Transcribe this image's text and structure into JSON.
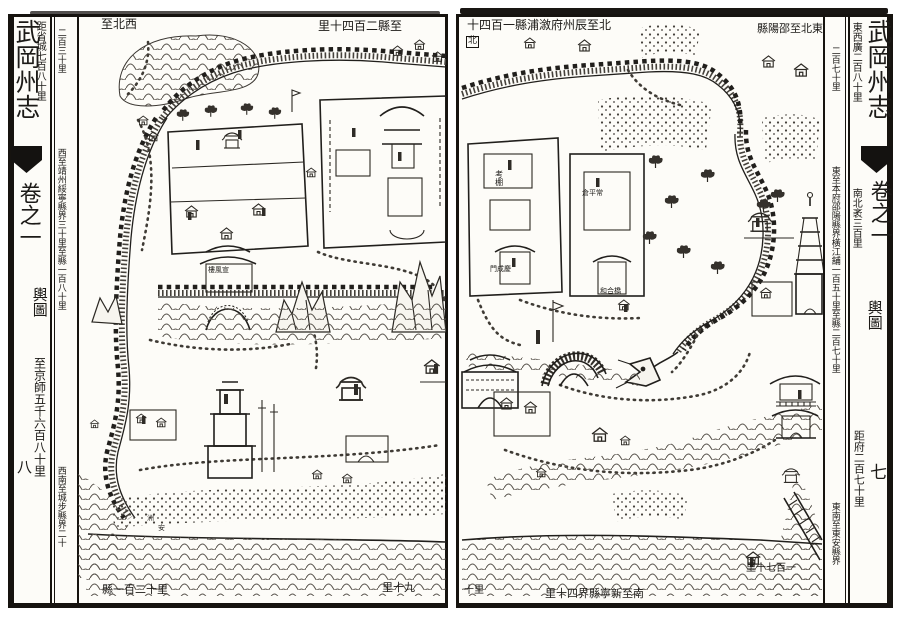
{
  "book": {
    "title": "武岡州志",
    "volume": "卷之一",
    "section": "輿圖"
  },
  "ink_color": "#1c1a17",
  "paper_color": "#fdfcf8",
  "left_page": {
    "page_number": "八",
    "margin_notes": {
      "to_provincial_capital": "距省城七百八十里",
      "to_imperial_capital": "至京師五千六百八十里"
    },
    "texts": [
      {
        "name": "caption-northwest",
        "text": "至北西",
        "x": 101,
        "y": 18,
        "size": 12
      },
      {
        "name": "caption-northwest-distance",
        "text": "里十四百二縣至",
        "x": 318,
        "y": 20,
        "size": 12
      },
      {
        "name": "column-note-north",
        "text": "二百三十里",
        "x": 55,
        "y": 28,
        "vertical": true,
        "size": 9
      },
      {
        "name": "column-note-west",
        "text": "西至靖州綏寧縣界三十里至縣一百八十里",
        "x": 55,
        "y": 148,
        "vertical": true,
        "size": 9
      },
      {
        "name": "column-note-southwest",
        "text": "西南至城步縣界二十",
        "x": 55,
        "y": 466,
        "vertical": true,
        "size": 9
      },
      {
        "name": "caption-south-distance",
        "text": "縣一百二十里",
        "x": 102,
        "y": 584,
        "size": 11
      },
      {
        "name": "caption-south",
        "text": "里十九",
        "x": 382,
        "y": 582,
        "size": 11
      },
      {
        "name": "xuanfeng-tower-label",
        "text": "樓風宣",
        "x": 208,
        "y": 267,
        "size": 7
      },
      {
        "name": "islet-label",
        "text": "洲",
        "x": 146,
        "y": 514,
        "vertical": true,
        "size": 7
      },
      {
        "name": "islet-label-2",
        "text": "安",
        "x": 157,
        "y": 524,
        "vertical": true,
        "size": 7
      }
    ]
  },
  "right_page": {
    "page_number": "七",
    "margin_notes": {
      "east_west_width": "東西廣二百八十里",
      "north_south_length": "南北袤三百里",
      "to_prefecture": "距府二百七十里"
    },
    "texts": [
      {
        "name": "caption-north",
        "text": "十四百一縣浦漵府州辰至北",
        "x": 467,
        "y": 19,
        "size": 12
      },
      {
        "name": "north-marker",
        "text": "北",
        "x": 466,
        "y": 36,
        "size": 9,
        "boxed": true
      },
      {
        "name": "caption-northeast",
        "text": "縣陽邵至北東",
        "x": 757,
        "y": 23,
        "size": 11
      },
      {
        "name": "column-note-northeast",
        "text": "二百七十里",
        "x": 829,
        "y": 46,
        "vertical": true,
        "size": 9
      },
      {
        "name": "column-note-east",
        "text": "東至本府邵陽縣界橫江舖一百五十里至縣二百七十里",
        "x": 829,
        "y": 166,
        "vertical": true,
        "size": 9
      },
      {
        "name": "column-note-southeast",
        "text": "東南至東安縣界",
        "x": 829,
        "y": 502,
        "vertical": true,
        "size": 9
      },
      {
        "name": "caption-south-left",
        "text": "十里",
        "x": 464,
        "y": 586,
        "size": 10
      },
      {
        "name": "caption-south",
        "text": "里十四界縣寧新至南",
        "x": 545,
        "y": 588,
        "size": 11
      },
      {
        "name": "caption-southeast-distance",
        "text": "里十七百一",
        "x": 746,
        "y": 564,
        "size": 10
      },
      {
        "name": "examination-hall-label",
        "text": "考棚",
        "x": 494,
        "y": 170,
        "vertical": true,
        "size": 8
      },
      {
        "name": "granary-label",
        "text": "倉平常",
        "x": 582,
        "y": 190,
        "size": 7
      },
      {
        "name": "gate-label",
        "text": "門成慶",
        "x": 490,
        "y": 266,
        "size": 7
      },
      {
        "name": "bridge-label",
        "text": "和合橋",
        "x": 600,
        "y": 288,
        "size": 7
      }
    ]
  }
}
